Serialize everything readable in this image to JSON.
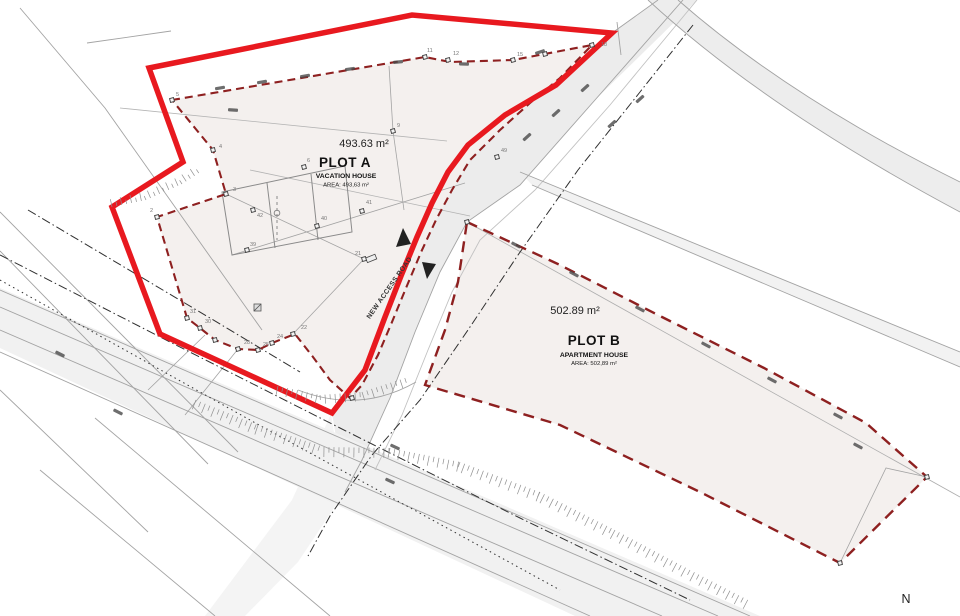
{
  "drawing": {
    "plot_a": {
      "name": "PLOT A",
      "building_type": "VACATION HOUSE",
      "area_caption": "AREA: 493,63 m²",
      "area_value": "493.63 m²"
    },
    "plot_b": {
      "name": "PLOT B",
      "building_type": "APARTMENT HOUSE",
      "area_caption": "AREA: 502,89 m²",
      "area_value": "502.89 m²"
    },
    "road_label": "NEW ACCESS ROAD",
    "north_label": "N",
    "colors": {
      "boundary_red": "#e8191f",
      "parcel_dashed_red": "#8e2020",
      "plot_fill": "#f4f0ee",
      "road_fill": "#ececec",
      "survey_gray": "#a3a3a3"
    },
    "vertex_labels": [
      {
        "n": "2",
        "x": 150,
        "y": 212
      },
      {
        "n": "3",
        "x": 233,
        "y": 191
      },
      {
        "n": "4",
        "x": 219,
        "y": 148
      },
      {
        "n": "5",
        "x": 176,
        "y": 96
      },
      {
        "n": "6",
        "x": 307,
        "y": 162
      },
      {
        "n": "9",
        "x": 397,
        "y": 127
      },
      {
        "n": "11",
        "x": 427,
        "y": 52
      },
      {
        "n": "12",
        "x": 453,
        "y": 55
      },
      {
        "n": "15",
        "x": 517,
        "y": 56
      },
      {
        "n": "18",
        "x": 601,
        "y": 46
      },
      {
        "n": "21",
        "x": 355,
        "y": 255
      },
      {
        "n": "22",
        "x": 301,
        "y": 329
      },
      {
        "n": "24",
        "x": 277,
        "y": 338
      },
      {
        "n": "25",
        "x": 263,
        "y": 346
      },
      {
        "n": "28",
        "x": 244,
        "y": 344
      },
      {
        "n": "30",
        "x": 205,
        "y": 323
      },
      {
        "n": "31",
        "x": 190,
        "y": 313
      },
      {
        "n": "39",
        "x": 250,
        "y": 246
      },
      {
        "n": "40",
        "x": 321,
        "y": 220
      },
      {
        "n": "41",
        "x": 366,
        "y": 204
      },
      {
        "n": "42",
        "x": 257,
        "y": 217
      },
      {
        "n": "49",
        "x": 501,
        "y": 152
      }
    ]
  }
}
